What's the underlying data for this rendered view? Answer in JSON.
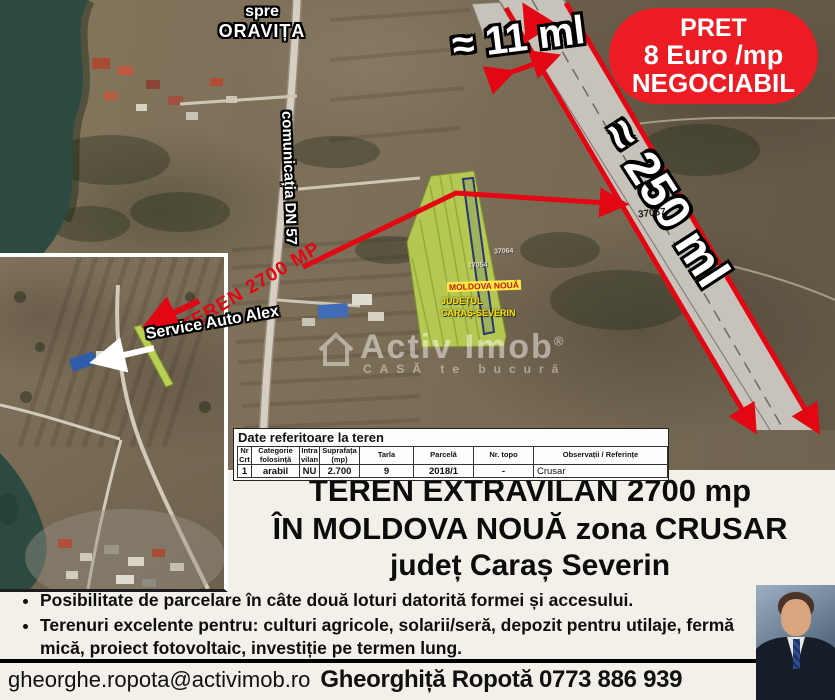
{
  "colors": {
    "accent_red": "#e30613",
    "badge_red": "#ec1c24",
    "parcel_green": "#b9d052",
    "water": "#2d4b42",
    "bottom_bg": "#f3f0ea"
  },
  "badge": {
    "line1": "PRET",
    "line2": "8 Euro /mp",
    "line3": "NEGOCIABIL"
  },
  "map": {
    "labels": {
      "direction_line1": "spre",
      "direction_line2": "ORAVIȚA",
      "road_name": "comunicația DN 57",
      "width_measure": "≈ 11 ml",
      "length_measure": "≈ 250 ml",
      "road_parcel_number": "37067",
      "teren_callout": "TEREN 2700 MP",
      "service_label": "Service Auto Alex",
      "parcel_town": "MOLDOVA NOUĂ",
      "parcel_county_line1": "JUDEȚUL",
      "parcel_county_line2": "CARAȘ-SEVERIN",
      "parcel_number_1": "37064",
      "parcel_number_2": "17054"
    },
    "watermark": {
      "brand": "Activ Imob",
      "reg": "®",
      "slogan": "CASĂ te bucură"
    }
  },
  "table": {
    "title": "Date referitoare la teren",
    "headers": [
      "Nr Crt",
      "Categorie folosință",
      "Intra vilan",
      "Suprafața (mp)",
      "Tarla",
      "Parcelă",
      "Nr. topo",
      "Observații / Referințe"
    ],
    "rows": [
      [
        "1",
        "arabil",
        "NU",
        "2.700",
        "9",
        "2018/1",
        "-",
        "Crusar"
      ]
    ]
  },
  "title": {
    "line1": "TEREN EXTRAVILAN 2700 mp",
    "line2": "ÎN MOLDOVA NOUĂ zona CRUSAR",
    "line3": "județ Caraș Severin"
  },
  "bullets": [
    "Posibilitate de parcelare în câte două loturi datorită formei și accesului.",
    "Terenuri excelente pentru: culturi agricole, solarii/seră, depozit pentru utilaje, fermă mică, proiect fotovoltaic, investiție pe termen lung."
  ],
  "footer": {
    "email": "gheorghe.ropota@activimob.ro",
    "agent": "Gheorghiță Ropotă 0773 886 939"
  }
}
